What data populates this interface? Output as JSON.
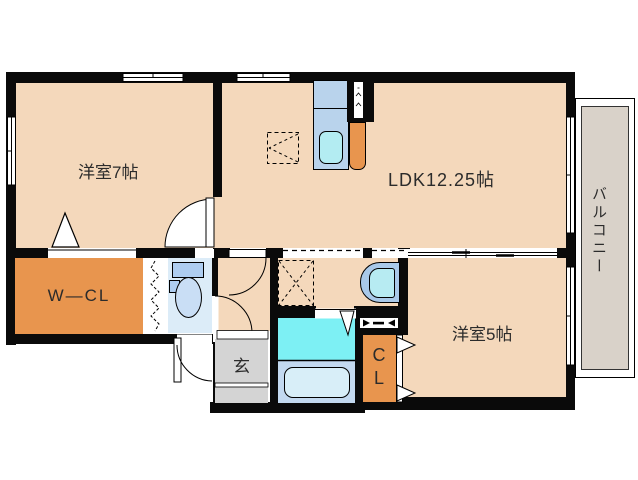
{
  "plan_title": "apartment-floor-plan",
  "rooms": {
    "western7": "洋室7帖",
    "ldk": "LDK12.25帖",
    "western5": "洋室5帖",
    "balcony": "バルコニー",
    "wcl": "W—CL",
    "genkan": "玄",
    "cl": "CL"
  },
  "fixtures": [
    "kitchen-counter",
    "kitchen-sink",
    "refrigerator-space",
    "pipe-space",
    "washing-machine-space",
    "wash-basin",
    "washroom",
    "bathtub",
    "toilet",
    "entrance-door",
    "sliding-door",
    "folding-door",
    "window"
  ],
  "palette": {
    "floor": "#f4d8bb",
    "wall": "#0a0a0a",
    "orange": "#e8954e",
    "genkan": "#d4d4d4",
    "balcony": "#d9d2c9",
    "toiletfloor": "#dcecf8",
    "counter": "#b9d3ec",
    "sink": "#b3ecf2",
    "washroom": "#7df0f4",
    "bathfloor": "#c3d9f0",
    "tub": "#d8eef8",
    "fixture": "#aecdf0",
    "bowl": "#c9def5",
    "basinouter": "#a9c9e9",
    "basininner": "#b7ebf2",
    "text": "#2b2b2b"
  }
}
